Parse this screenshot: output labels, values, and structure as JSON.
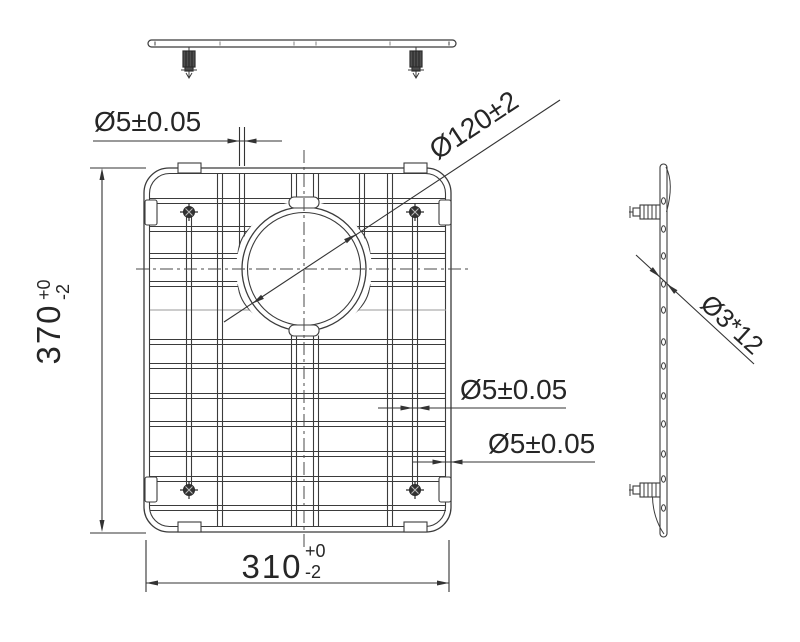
{
  "labels": {
    "wire_dia_top": "Ø5±0.05",
    "wire_dia_mid": "Ø5±0.05",
    "wire_dia_frame": "Ø5±0.05",
    "hole_dia": "Ø120±2",
    "foot_spec": "Ø3*12",
    "height": {
      "value": "370",
      "tol_plus": "+0",
      "tol_minus": "-2"
    },
    "width": {
      "value": "310",
      "tol_plus": "+0",
      "tol_minus": "-2"
    }
  },
  "colors": {
    "line": "#3b3b3b",
    "text": "#262626",
    "background": "#ffffff",
    "thin_wire": "#999999"
  }
}
